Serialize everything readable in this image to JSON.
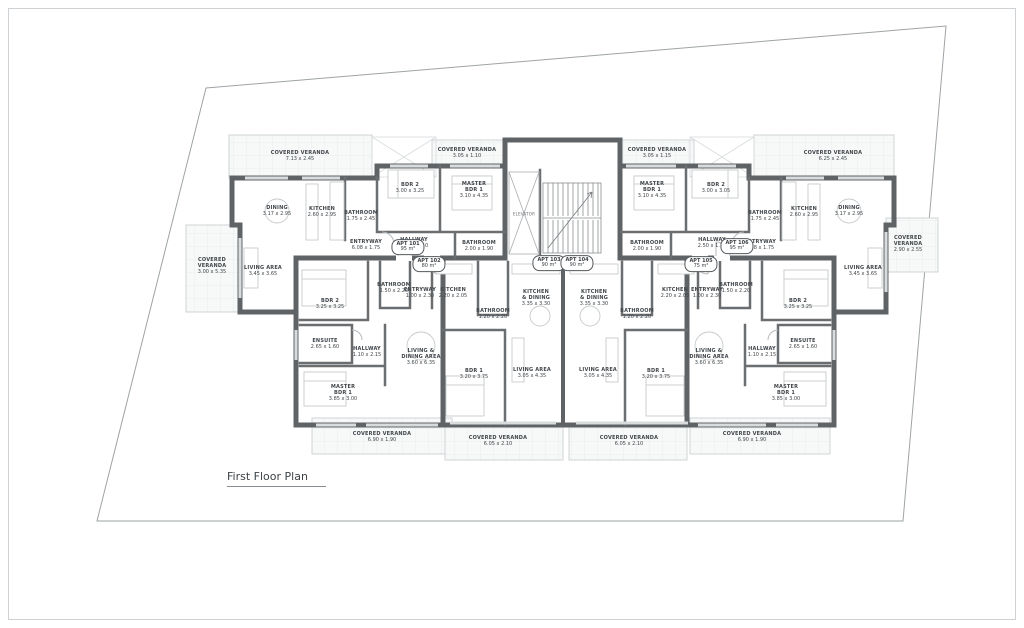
{
  "title": {
    "label": "First Floor Plan"
  },
  "core": {
    "elevator_label": "ELEVATOR"
  },
  "colors": {
    "wall": "#5f6366",
    "partition": "#6a6e71",
    "thin_line": "#b4b8bb",
    "veranda_fill": "#f7f8f8",
    "veranda_grid": "#e7e9ea",
    "text": "#41464a",
    "boundary": "#9ea3a6"
  },
  "apartments": [
    {
      "label": "APT 101",
      "area": "95 m²",
      "x": 408,
      "y": 247
    },
    {
      "label": "APT 102",
      "area": "80 m²",
      "x": 429,
      "y": 264
    },
    {
      "label": "APT 103",
      "area": "90 m²",
      "x": 549,
      "y": 263
    },
    {
      "label": "APT 104",
      "area": "90 m²",
      "x": 577,
      "y": 263
    },
    {
      "label": "APT 105",
      "area": "75 m²",
      "x": 701,
      "y": 264
    },
    {
      "label": "APT 106",
      "area": "95 m²",
      "x": 737,
      "y": 246
    }
  ],
  "rooms": [
    {
      "label": "COVERED VERANDA",
      "dims": "7.13 x 2.45",
      "x": 300,
      "y": 156
    },
    {
      "label": "DINING",
      "dims": "3.17 x 2.95",
      "x": 277,
      "y": 211
    },
    {
      "label": "KITCHEN",
      "dims": "2.60 x 2.95",
      "x": 322,
      "y": 212
    },
    {
      "label": "BATHROOM",
      "dims": "1.75 x 2.45",
      "x": 361,
      "y": 216
    },
    {
      "label": "BDR 2",
      "dims": "3.00 x 3.25",
      "x": 410,
      "y": 188
    },
    {
      "label": "HALLWAY",
      "dims": "2.50 x 1.10",
      "x": 414,
      "y": 243
    },
    {
      "label": "MASTER\nBDR 1",
      "dims": "3.10 x 4.35",
      "x": 474,
      "y": 190
    },
    {
      "label": "BATHROOM",
      "dims": "2.00 x 1.90",
      "x": 479,
      "y": 246
    },
    {
      "label": "ENTRYWAY",
      "dims": "6.08 x 1.75",
      "x": 366,
      "y": 245
    },
    {
      "label": "COVERED VERANDA",
      "dims": "3.05 x 1.10",
      "x": 467,
      "y": 153
    },
    {
      "label": "LIVING AREA",
      "dims": "3.45 x 3.65",
      "x": 263,
      "y": 271
    },
    {
      "label": "COVERED\nVERANDA",
      "dims": "3.00 x 5.35",
      "x": 212,
      "y": 266
    },
    {
      "label": "COVERED VERANDA",
      "dims": "3.05 x 1.15",
      "x": 657,
      "y": 153
    },
    {
      "label": "MASTER\nBDR 1",
      "dims": "3.10 x 4.35",
      "x": 652,
      "y": 190
    },
    {
      "label": "BDR 2",
      "dims": "3.00 x 3.05",
      "x": 716,
      "y": 188
    },
    {
      "label": "BATHROOM",
      "dims": "2.00 x 1.90",
      "x": 647,
      "y": 246
    },
    {
      "label": "HALLWAY",
      "dims": "2.50 x 1.10",
      "x": 712,
      "y": 243
    },
    {
      "label": "BATHROOM",
      "dims": "1.75 x 2.45",
      "x": 765,
      "y": 216
    },
    {
      "label": "KITCHEN",
      "dims": "2.60 x 2.95",
      "x": 804,
      "y": 212
    },
    {
      "label": "DINING",
      "dims": "3.17 x 2.95",
      "x": 849,
      "y": 211
    },
    {
      "label": "ENTRYWAY",
      "dims": "6.08 x 1.75",
      "x": 760,
      "y": 245
    },
    {
      "label": "COVERED VERANDA",
      "dims": "6.25 x 2.45",
      "x": 833,
      "y": 156
    },
    {
      "label": "LIVING AREA",
      "dims": "3.45 x 3.65",
      "x": 863,
      "y": 271
    },
    {
      "label": "COVERED\nVERANDA",
      "dims": "2.90 x 2.55",
      "x": 908,
      "y": 244
    },
    {
      "label": "BDR 2",
      "dims": "3.25 x 3.25",
      "x": 330,
      "y": 304
    },
    {
      "label": "ENSUITE",
      "dims": "2.65 x 1.60",
      "x": 325,
      "y": 344
    },
    {
      "label": "HALLWAY",
      "dims": "1.10 x 2.15",
      "x": 367,
      "y": 352
    },
    {
      "label": "MASTER\nBDR 1",
      "dims": "3.85 x 3.00",
      "x": 343,
      "y": 393
    },
    {
      "label": "BATHROOM",
      "dims": "1.50 x 2.20",
      "x": 394,
      "y": 288
    },
    {
      "label": "ENTRYWAY",
      "dims": "1.00 x 2.30",
      "x": 420,
      "y": 293
    },
    {
      "label": "KITCHEN",
      "dims": "2.20 x 2.05",
      "x": 453,
      "y": 293
    },
    {
      "label": "LIVING &\nDINING AREA",
      "dims": "3.60 x 6.35",
      "x": 421,
      "y": 357
    },
    {
      "label": "BDR 1",
      "dims": "3.20 x 3.75",
      "x": 474,
      "y": 374
    },
    {
      "label": "COVERED VERANDA",
      "dims": "6.90 x 1.90",
      "x": 382,
      "y": 437
    },
    {
      "label": "BATHROOM",
      "dims": "1.20 x 2.20",
      "x": 493,
      "y": 314
    },
    {
      "label": "KITCHEN\n& DINING",
      "dims": "3.35 x 3.30",
      "x": 536,
      "y": 298
    },
    {
      "label": "LIVING AREA",
      "dims": "3.05 x 4.35",
      "x": 532,
      "y": 373
    },
    {
      "label": "COVERED VERANDA",
      "dims": "6.05 x 2.10",
      "x": 498,
      "y": 441
    },
    {
      "label": "KITCHEN\n& DINING",
      "dims": "3.35 x 3.30",
      "x": 594,
      "y": 298
    },
    {
      "label": "BATHROOM",
      "dims": "1.20 x 2.20",
      "x": 637,
      "y": 314
    },
    {
      "label": "LIVING AREA",
      "dims": "3.05 x 4.35",
      "x": 598,
      "y": 373
    },
    {
      "label": "COVERED VERANDA",
      "dims": "6.05 x 2.10",
      "x": 629,
      "y": 441
    },
    {
      "label": "KITCHEN",
      "dims": "2.20 x 2.05",
      "x": 675,
      "y": 293
    },
    {
      "label": "ENTRYWAY",
      "dims": "1.00 x 2.30",
      "x": 707,
      "y": 293
    },
    {
      "label": "BATHROOM",
      "dims": "1.50 x 2.20",
      "x": 736,
      "y": 288
    },
    {
      "label": "BDR 1",
      "dims": "3.20 x 3.75",
      "x": 656,
      "y": 374
    },
    {
      "label": "LIVING &\nDINING AREA",
      "dims": "3.60 x 6.35",
      "x": 709,
      "y": 357
    },
    {
      "label": "HALLWAY",
      "dims": "1.10 x 2.15",
      "x": 762,
      "y": 352
    },
    {
      "label": "ENSUITE",
      "dims": "2.65 x 1.60",
      "x": 803,
      "y": 344
    },
    {
      "label": "BDR 2",
      "dims": "3.25 x 3.25",
      "x": 798,
      "y": 304
    },
    {
      "label": "MASTER\nBDR 1",
      "dims": "3.85 x 3.00",
      "x": 786,
      "y": 393
    },
    {
      "label": "COVERED VERANDA",
      "dims": "6.90 x 1.90",
      "x": 752,
      "y": 437
    }
  ]
}
